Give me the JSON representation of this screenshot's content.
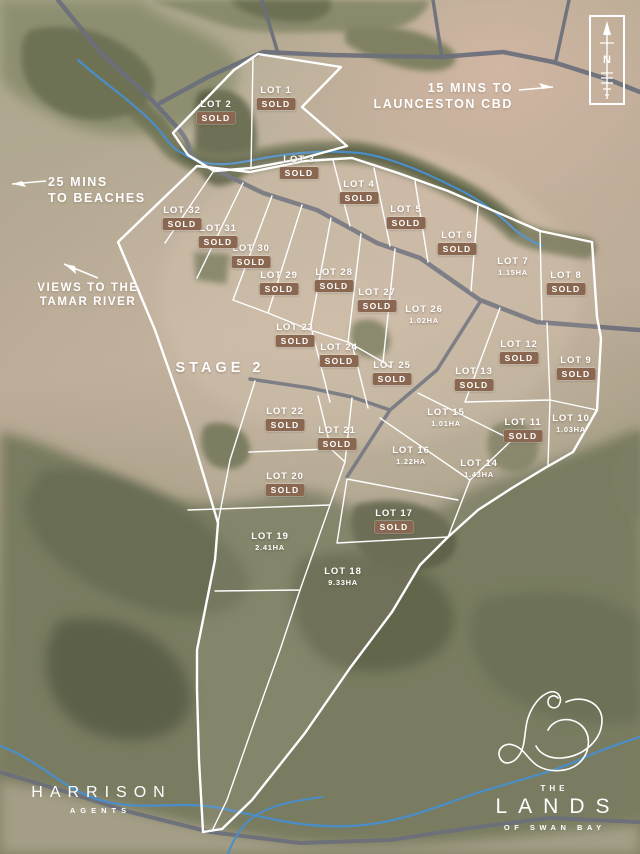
{
  "map": {
    "title_context": "Land subdivision site map",
    "compass": {
      "letter": "N"
    },
    "annotations": {
      "cbd": {
        "line1": "15 MINS TO",
        "line2": "LAUNCESTON CBD"
      },
      "beaches": {
        "line1": "25 MINS",
        "line2": "TO BEACHES"
      },
      "tamar": {
        "line1": "VIEWS TO THE",
        "line2": "TAMAR RIVER"
      },
      "stage_label": "STAGE 2"
    },
    "lots": [
      {
        "name": "LOT 1",
        "status": "SOLD",
        "x": 276,
        "y": 92
      },
      {
        "name": "LOT 2",
        "status": "SOLD",
        "x": 216,
        "y": 106
      },
      {
        "name": "LOT 3",
        "status": "SOLD",
        "x": 299,
        "y": 161
      },
      {
        "name": "LOT 4",
        "status": "SOLD",
        "x": 359,
        "y": 186
      },
      {
        "name": "LOT 5",
        "status": "SOLD",
        "x": 406,
        "y": 211
      },
      {
        "name": "LOT 6",
        "status": "SOLD",
        "x": 457,
        "y": 237
      },
      {
        "name": "LOT 7",
        "area": "1.15HA",
        "x": 513,
        "y": 263
      },
      {
        "name": "LOT 8",
        "status": "SOLD",
        "x": 566,
        "y": 277
      },
      {
        "name": "LOT 9",
        "status": "SOLD",
        "x": 576,
        "y": 362
      },
      {
        "name": "LOT 10",
        "area": "1.03HA",
        "x": 571,
        "y": 420
      },
      {
        "name": "LOT 11",
        "status": "SOLD",
        "x": 523,
        "y": 424
      },
      {
        "name": "LOT 12",
        "status": "SOLD",
        "x": 519,
        "y": 346
      },
      {
        "name": "LOT 13",
        "status": "SOLD",
        "x": 474,
        "y": 373
      },
      {
        "name": "LOT 14",
        "area": "1.43HA",
        "x": 479,
        "y": 465
      },
      {
        "name": "LOT 15",
        "area": "1.01HA",
        "x": 446,
        "y": 414
      },
      {
        "name": "LOT 16",
        "area": "1.22HA",
        "x": 411,
        "y": 452
      },
      {
        "name": "LOT 17",
        "status": "SOLD",
        "x": 394,
        "y": 515
      },
      {
        "name": "LOT 18",
        "area": "9.33HA",
        "x": 343,
        "y": 573
      },
      {
        "name": "LOT 19",
        "area": "2.41HA",
        "x": 270,
        "y": 538
      },
      {
        "name": "LOT 20",
        "status": "SOLD",
        "x": 285,
        "y": 478
      },
      {
        "name": "LOT 21",
        "status": "SOLD",
        "x": 337,
        "y": 432
      },
      {
        "name": "LOT 22",
        "status": "SOLD",
        "x": 285,
        "y": 413
      },
      {
        "name": "LOT 23",
        "status": "SOLD",
        "x": 295,
        "y": 329
      },
      {
        "name": "LOT 24",
        "status": "SOLD",
        "x": 339,
        "y": 349
      },
      {
        "name": "LOT 25",
        "status": "SOLD",
        "x": 392,
        "y": 367
      },
      {
        "name": "LOT 26",
        "area": "1.02HA",
        "x": 424,
        "y": 311
      },
      {
        "name": "LOT 27",
        "status": "SOLD",
        "x": 377,
        "y": 294
      },
      {
        "name": "LOT 28",
        "status": "SOLD",
        "x": 334,
        "y": 274
      },
      {
        "name": "LOT 29",
        "status": "SOLD",
        "x": 279,
        "y": 277
      },
      {
        "name": "LOT 30",
        "status": "SOLD",
        "x": 251,
        "y": 250
      },
      {
        "name": "LOT 31",
        "status": "SOLD",
        "x": 218,
        "y": 230
      },
      {
        "name": "LOT 32",
        "status": "SOLD",
        "x": 182,
        "y": 212
      }
    ],
    "branding": {
      "agency": {
        "name": "HARRISON",
        "tagline": "AGENTS"
      },
      "development": {
        "prefix": "THE",
        "name": "LANDS",
        "suffix": "OF SWAN BAY"
      }
    },
    "colors": {
      "sold_badge": "#8a6750",
      "boundary": "#ffffff",
      "road": "#6b6f7b",
      "river": "#4a8ec9"
    }
  }
}
